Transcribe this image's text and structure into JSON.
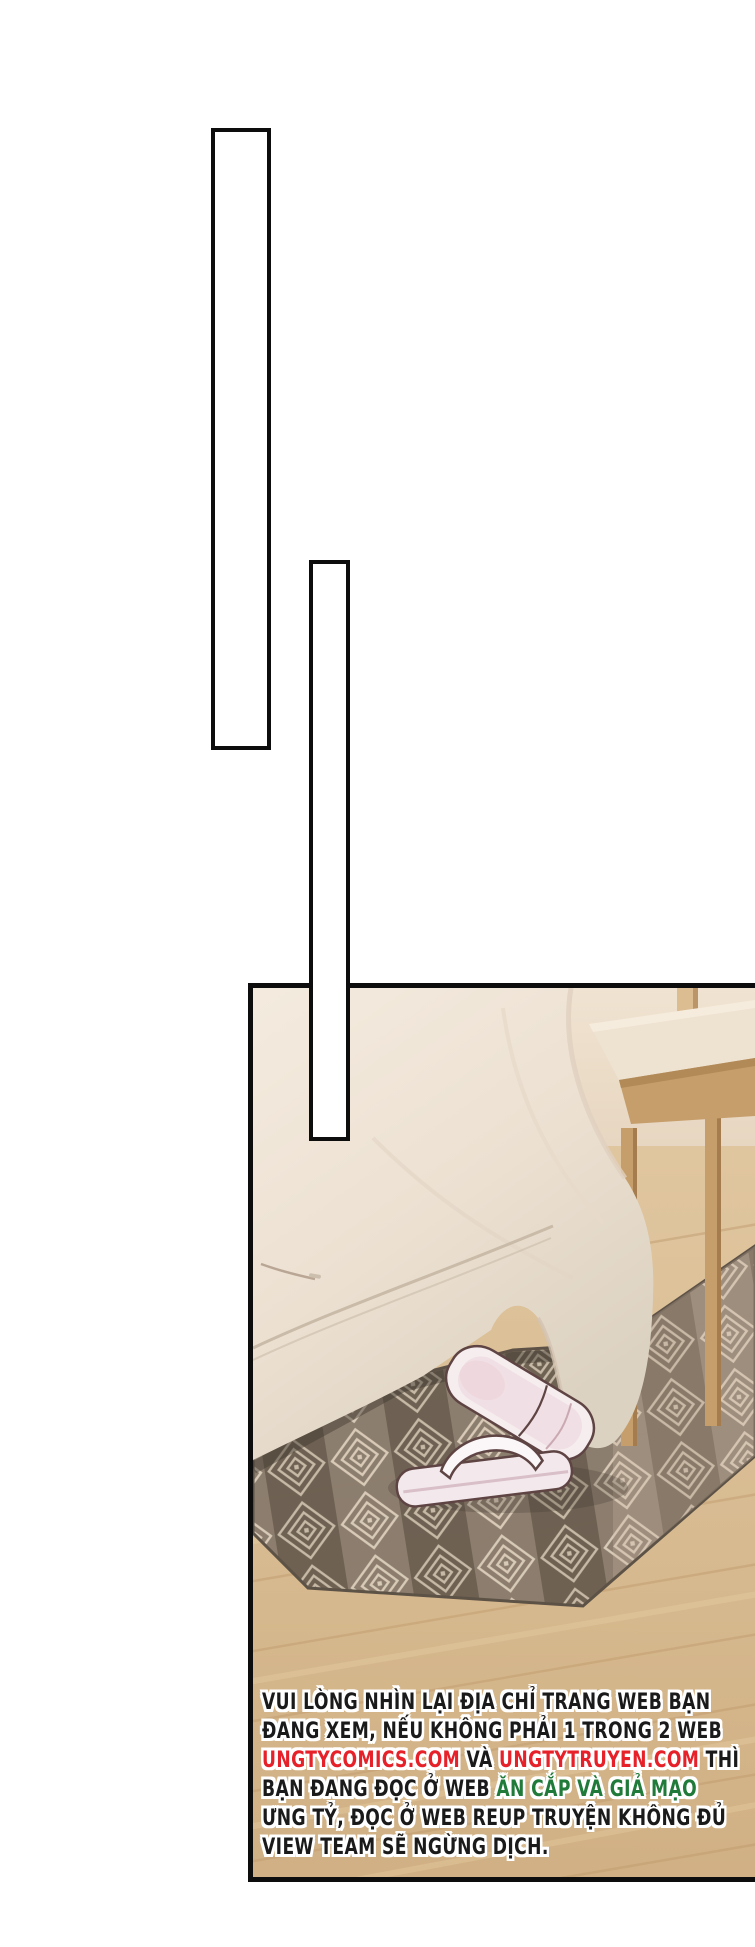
{
  "page": {
    "background": "#ffffff"
  },
  "speech_tails": {
    "tail_1": {
      "fill": "#ffffff",
      "border_color": "#0d0d0d"
    },
    "tail_2": {
      "fill": "#ffffff",
      "border_color": "#0d0d0d"
    }
  },
  "photo_panel": {
    "border_color": "#0d0d0d",
    "scene": {
      "elements": [
        "wall",
        "wood-posts",
        "bench",
        "bed-duvet",
        "mattress-base",
        "zipper",
        "patterned-rug",
        "slippers",
        "wood-floor"
      ],
      "palette": {
        "wall": "#ebdcc8",
        "duvet_light": "#f2e9dd",
        "duvet_shadow": "#ddcfbe",
        "bench_cushion": "#eee2d1",
        "bench_wood": "#c69e6c",
        "rug_base": "#8a7c6d",
        "rug_dark": "#6b5f51",
        "rug_line": "#d8cbb8",
        "floor": "#d8ba8e",
        "floor_grain": "#bf9a6c",
        "slipper": "#f6edef",
        "slipper_outline": "#5f4444"
      }
    }
  },
  "notice": {
    "text_colors": {
      "default": "#1a1a1a",
      "link_red": "#e62129",
      "warning_green": "#207a39",
      "outline": "#ffffff"
    },
    "lines": [
      {
        "segments": [
          {
            "text": "VUI LÒNG NHÌN LẠI ĐỊA CHỈ TRANG WEB BẠN",
            "color": "default"
          }
        ]
      },
      {
        "segments": [
          {
            "text": "ĐANG XEM, NẾU KHÔNG PHẢI 1 TRONG 2 WEB",
            "color": "default"
          }
        ]
      },
      {
        "segments": [
          {
            "text": "UNGTYCOMICS.COM",
            "color": "link_red"
          },
          {
            "text": " VÀ ",
            "color": "default"
          },
          {
            "text": "UNGTYTRUYEN.COM",
            "color": "link_red"
          },
          {
            "text": " THÌ",
            "color": "default"
          }
        ]
      },
      {
        "segments": [
          {
            "text": "BẠN ĐANG ĐỌC Ở WEB ",
            "color": "default"
          },
          {
            "text": "ĂN CẮP VÀ GIẢ MẠO",
            "color": "warning_green"
          }
        ]
      },
      {
        "segments": [
          {
            "text": "ƯNG TỶ, ĐỌC Ở WEB REUP TRUYỆN KHÔNG ĐỦ",
            "color": "default"
          }
        ]
      },
      {
        "segments": [
          {
            "text": "VIEW TEAM SẼ NGỪNG DỊCH.",
            "color": "default"
          }
        ]
      }
    ]
  }
}
